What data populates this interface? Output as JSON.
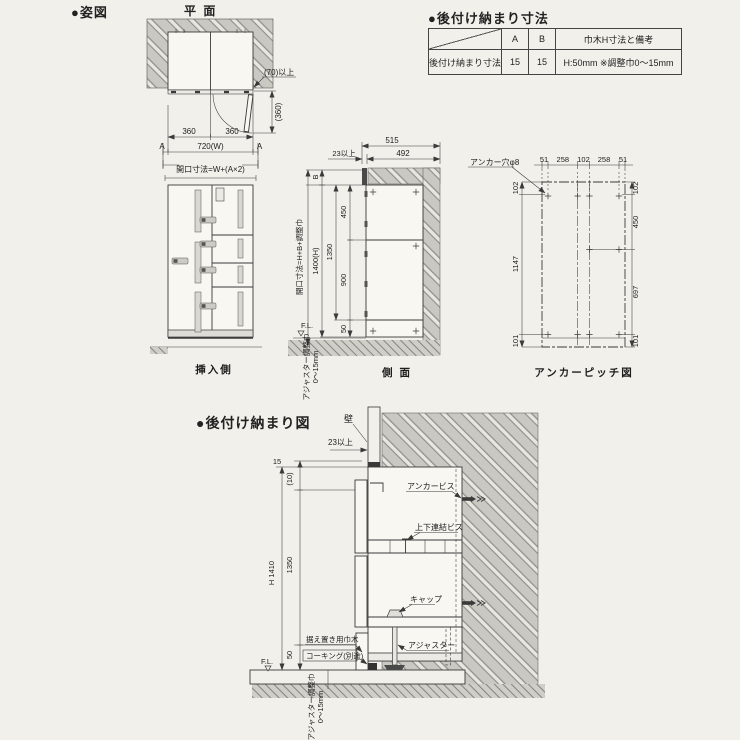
{
  "titles": {
    "shizu": "●姿図",
    "plan": "平 面",
    "table_title": "●後付け納まり寸法",
    "detail_title": "●後付け納まり図",
    "front_caption": "挿入側",
    "side_caption": "側 面",
    "anchor_caption": "アンカーピッチ図"
  },
  "table": {
    "col_a": "A",
    "col_b": "B",
    "col_note": "巾木H寸法と備考",
    "row_label": "後付け納まり寸法",
    "a": "15",
    "b": "15",
    "note": "H:50mm ※調整巾0〜15mm"
  },
  "plan": {
    "min70": "(70)以上",
    "v360": "(360)",
    "d360l": "360",
    "d360r": "360",
    "a_left": "A",
    "a_right": "A",
    "w720": "720(W)",
    "opening": "開口寸法=W+(A×2)"
  },
  "side": {
    "d515": "515",
    "d23": "23以上",
    "d492": "492",
    "b": "B",
    "opening": "開口寸法=H+B+調整巾",
    "d1400": "1400(H)",
    "d1350": "1350",
    "d450": "450",
    "d900": "900",
    "d50": "50",
    "fl": "F.L.",
    "adj1": "アジャスター調整巾",
    "adj2": "0〜15mm"
  },
  "anchor": {
    "hole": "アンカー穴φ8",
    "t": [
      "51",
      "258",
      "102",
      "258",
      "51"
    ],
    "l": [
      "102",
      "1147",
      "101"
    ],
    "r": [
      "102",
      "450",
      "697",
      "101"
    ]
  },
  "detail": {
    "wall": "壁",
    "d23": "23以上",
    "d15": "15",
    "d10": "(10)",
    "d1350": "1350",
    "dh": "H 1410",
    "d50": "50",
    "fl": "F.L.",
    "screw": "アンカービス",
    "joint": "上下連結ビス",
    "cap": "キャップ",
    "skirt": "据え置き用巾木",
    "caulk": "コーキング(別途)",
    "adjuster": "アジャスター",
    "adj1": "アジャスター調整巾",
    "adj2": "0〜15mm"
  }
}
